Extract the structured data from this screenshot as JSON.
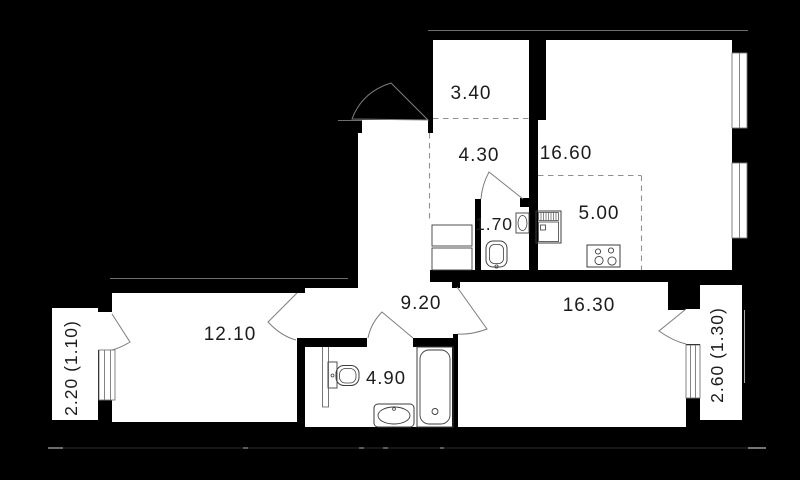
{
  "rooms": [
    {
      "key": "dressing",
      "area": "3.40"
    },
    {
      "key": "kitchen_living",
      "area": "16.60"
    },
    {
      "key": "hallway",
      "area": "4.30"
    },
    {
      "key": "wc",
      "area": "1.70"
    },
    {
      "key": "kitchen_zone",
      "area": "5.00"
    },
    {
      "key": "corridor",
      "area": "9.20"
    },
    {
      "key": "living_room",
      "area": "16.30"
    },
    {
      "key": "bedroom",
      "area": "12.10"
    },
    {
      "key": "bathroom",
      "area": "4.90"
    }
  ],
  "balconies": [
    {
      "key": "left",
      "label": "2.20 (1.10)"
    },
    {
      "key": "right",
      "label": "2.60 (1.30)"
    }
  ],
  "colors": {
    "background": "#000000",
    "floor": "#ffffff",
    "wall": "#000000",
    "edge_line": "#6e6e6e",
    "dashed_line": "#909090",
    "fixture_line": "#3d3d3d",
    "label_text": "#1c1c1c"
  },
  "fixtures": [
    "wc-sink",
    "wc-toilet",
    "hallway-cabinet",
    "hallway-washer",
    "kitchen-sink-cabinet",
    "kitchen-stove",
    "bathroom-toilet",
    "bathroom-sink",
    "bathtub"
  ],
  "windows": [
    "kitchen-window-upper",
    "kitchen-window-lower",
    "bedroom-balcony-window",
    "living-room-balcony-window"
  ],
  "doors": [
    "entrance-door",
    "wc-door",
    "bathroom-door",
    "bedroom-door",
    "living-room-door",
    "bedroom-balcony-door",
    "living-room-balcony-door"
  ]
}
